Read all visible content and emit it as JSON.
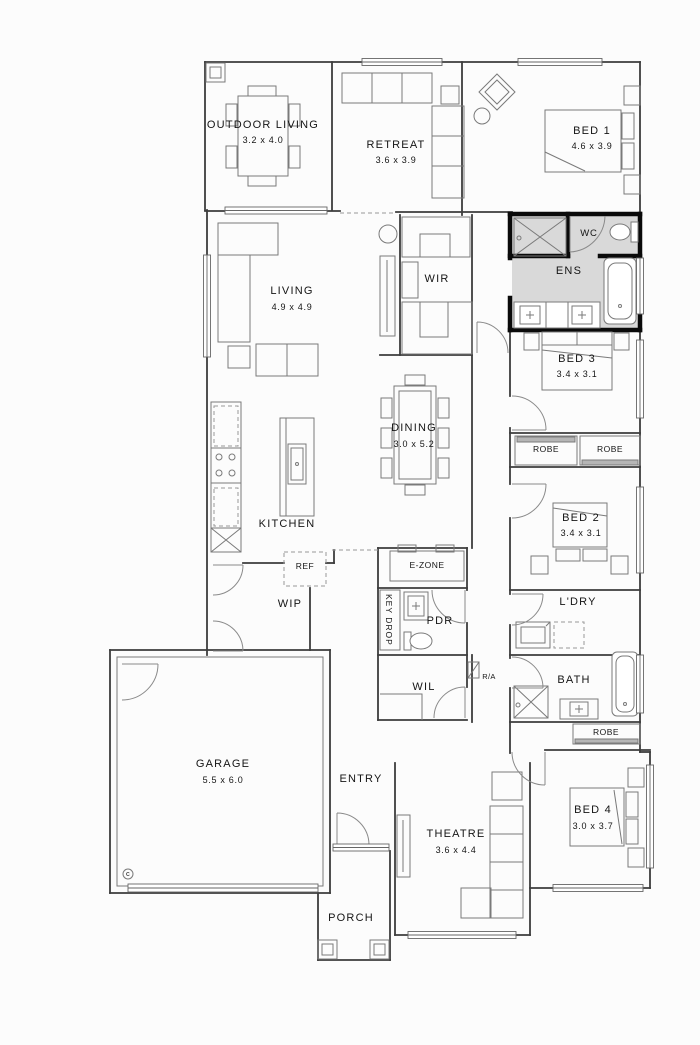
{
  "rooms": {
    "outdoor_living": {
      "label": "OUTDOOR LIVING",
      "dim": "3.2 x 4.0"
    },
    "retreat": {
      "label": "RETREAT",
      "dim": "3.6 x 3.9"
    },
    "bed1": {
      "label": "BED 1",
      "dim": "4.6 x 3.9"
    },
    "wc": {
      "label": "WC"
    },
    "ens": {
      "label": "ENS"
    },
    "living": {
      "label": "LIVING",
      "dim": "4.9 x 4.9"
    },
    "wir": {
      "label": "WIR"
    },
    "bed3": {
      "label": "BED 3",
      "dim": "3.4 x 3.1"
    },
    "dining": {
      "label": "DINING",
      "dim": "3.0 x 5.2"
    },
    "robe_bed3": {
      "label": "ROBE"
    },
    "robe_bed2": {
      "label": "ROBE"
    },
    "kitchen": {
      "label": "KITCHEN"
    },
    "ref": {
      "label": "REF"
    },
    "wip": {
      "label": "WIP"
    },
    "e_zone": {
      "label": "E-ZONE"
    },
    "key_drop": {
      "label": "KEY DROP"
    },
    "pdr": {
      "label": "PDR"
    },
    "bed2": {
      "label": "BED 2",
      "dim": "3.4 x 3.1"
    },
    "ldry": {
      "label": "L'DRY"
    },
    "wil": {
      "label": "WIL"
    },
    "return_air": {
      "label": "R/A"
    },
    "bath": {
      "label": "BATH"
    },
    "robe_bed4": {
      "label": "ROBE"
    },
    "garage": {
      "label": "GARAGE",
      "dim": "5.5 x 6.0",
      "marker": "c"
    },
    "entry": {
      "label": "ENTRY"
    },
    "theatre": {
      "label": "THEATRE",
      "dim": "3.6 x 4.4"
    },
    "bed4": {
      "label": "BED 4",
      "dim": "3.0 x 3.7"
    },
    "porch": {
      "label": "PORCH"
    }
  },
  "colors": {
    "wall": "#3d3d3d",
    "wet_area_wall": "#0a0a0a",
    "wet_area_fill": "#d9d9d9",
    "furniture_line": "#7a7a7a",
    "text": "#151515",
    "background": "#fcfcfc"
  }
}
